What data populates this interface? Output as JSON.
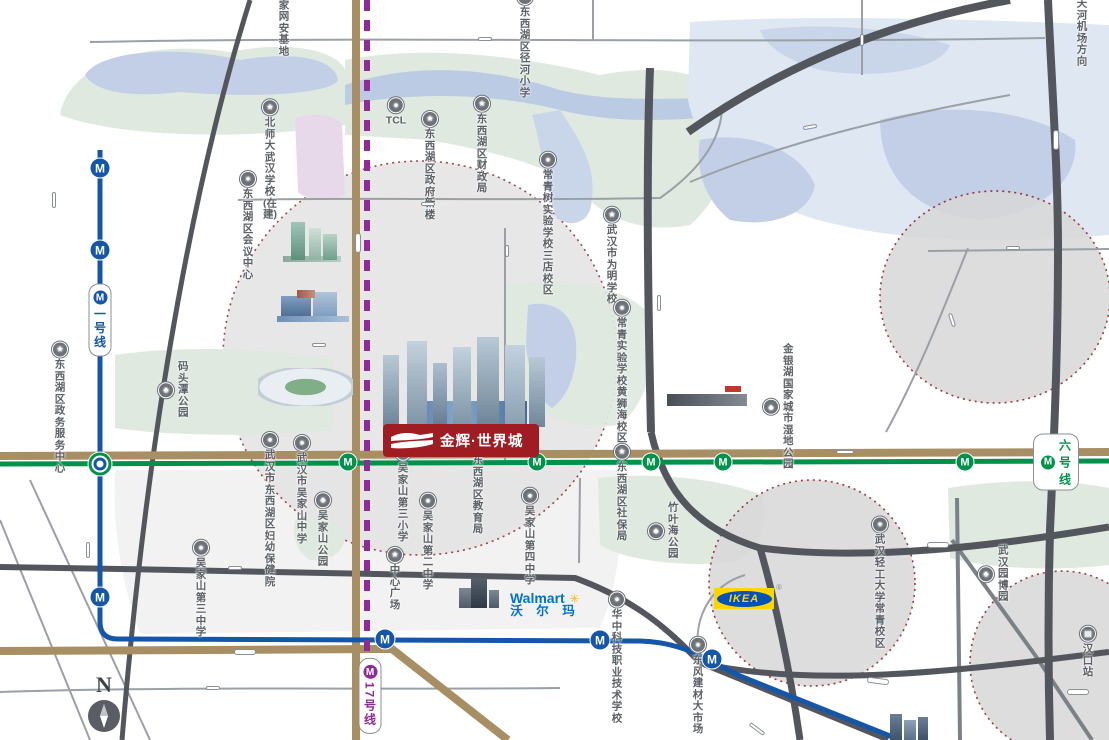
{
  "colors": {
    "line1": "#1456a8",
    "line6": "#00924a",
    "line17": "#8e2b96",
    "road_brown": "#a78e63",
    "road_dark": "#53575d",
    "circle_border": "#8b1b1b",
    "landmark_blue": "#1a57c5",
    "logo_red": "#9e1c22",
    "ikea_blue": "#0051ba",
    "ikea_yellow": "#ffd500",
    "walmart_blue": "#0071ce",
    "walmart_yellow": "#ffb71b",
    "park_green": "#dfe9df",
    "water_blue": "#c2cfe6"
  },
  "metro": {
    "m_glyph": "M"
  },
  "compass": {
    "n": "N"
  },
  "brands": {
    "project": {
      "name": "金辉·世界城"
    },
    "ikea": {
      "logo": "IKEA",
      "reg": "®"
    },
    "walmart": {
      "en": "Walmart",
      "spark": "✳",
      "zh": "沃 尔 玛"
    }
  },
  "caps": [
    {
      "t": "四环线",
      "x": 54,
      "y": 200,
      "cls": "v"
    },
    {
      "t": "临空港大道",
      "x": 358,
      "y": 243,
      "cls": "v big"
    },
    {
      "t": "机场高速",
      "x": 1056,
      "y": 140,
      "cls": "v big"
    },
    {
      "t": "硚孝高速",
      "x": 659,
      "y": 303,
      "cls": "v"
    },
    {
      "t": "九通路",
      "x": 88,
      "y": 550,
      "cls": "v"
    },
    {
      "t": "宏图六路",
      "x": 862,
      "y": 40,
      "cls": "v sm"
    },
    {
      "t": "三店路",
      "x": 507,
      "y": 251,
      "cls": "v sm"
    },
    {
      "t": "径河街",
      "x": 485,
      "y": 39,
      "cls": "sm"
    },
    {
      "t": "金北一路",
      "x": 428,
      "y": 204,
      "cls": "sm"
    },
    {
      "t": "祥云路",
      "x": 319,
      "y": 345,
      "cls": "sm"
    },
    {
      "t": "马池路",
      "x": 1013,
      "y": 248,
      "cls": "sm"
    },
    {
      "t": "金山大道",
      "x": 845,
      "y": 452,
      "cls": ""
    },
    {
      "t": "三环线",
      "x": 938,
      "y": 545,
      "cls": "big"
    },
    {
      "t": "东吴大道",
      "x": 235,
      "y": 568,
      "cls": "sm"
    },
    {
      "t": "东西湖大道",
      "x": 245,
      "y": 652,
      "cls": "big"
    },
    {
      "t": "平新大道",
      "x": 213,
      "y": 688,
      "cls": "sm"
    },
    {
      "t": "发展大道",
      "x": 1078,
      "y": 692,
      "cls": "big"
    },
    {
      "t": "环湖路",
      "x": 810,
      "y": 127,
      "cls": "sm",
      "rot": -10
    },
    {
      "t": "金银湖路",
      "x": 952,
      "y": 320,
      "cls": "sm",
      "rot": 72
    },
    {
      "t": "长丰大道高架",
      "x": 878,
      "y": 681,
      "cls": "big",
      "rot": 7
    },
    {
      "t": "解放大道",
      "x": 757,
      "y": 729,
      "cls": "",
      "rot": 37
    }
  ],
  "linecaps": [
    {
      "line": "l1",
      "t": "一号线",
      "x": 100,
      "y": 320,
      "cls": "v"
    },
    {
      "line": "l6",
      "t": "六号线",
      "x": 1056,
      "y": 462,
      "cls": ""
    },
    {
      "line": "l17",
      "t": "17号线",
      "x": 370,
      "y": 696,
      "cls": "v"
    }
  ],
  "stations": [
    {
      "line": "l1",
      "x": 100,
      "y": 168
    },
    {
      "line": "l1",
      "x": 100,
      "y": 250
    },
    {
      "line": "l1",
      "x": 100,
      "y": 597
    },
    {
      "line": "l1",
      "x": 385,
      "y": 639
    },
    {
      "line": "l1",
      "x": 600,
      "y": 640
    },
    {
      "line": "l1",
      "x": 712,
      "y": 659
    },
    {
      "line": "l6",
      "x": 348,
      "y": 462
    },
    {
      "line": "l6",
      "x": 537,
      "y": 462
    },
    {
      "line": "l6",
      "x": 651,
      "y": 462
    },
    {
      "line": "l6",
      "x": 723,
      "y": 462
    },
    {
      "line": "l6",
      "x": 965,
      "y": 462
    },
    {
      "line": "xch",
      "x": 100,
      "y": 464
    }
  ],
  "stnames": [
    {
      "t": "径河站",
      "x": 115,
      "y": 167,
      "a": "l",
      "line": "l1"
    },
    {
      "t": "三店站",
      "x": 115,
      "y": 248,
      "a": "l",
      "line": "l1"
    },
    {
      "t": "东吴大道站",
      "x": 116,
      "y": 593,
      "a": "l",
      "line": "l1"
    },
    {
      "t": "五环大道站",
      "x": 352,
      "y": 618,
      "a": "l",
      "line": "l1"
    },
    {
      "t": "额头湾站",
      "x": 578,
      "y": 618,
      "a": "l",
      "line": "l1"
    },
    {
      "t": "竹叶海站",
      "x": 706,
      "y": 640,
      "a": "l",
      "line": "l1"
    },
    {
      "t": "码头潭公园站",
      "x": 107,
      "y": 451,
      "a": "l",
      "line": "l6"
    },
    {
      "t": "五环体育中心站",
      "x": 361,
      "y": 475,
      "a": "l",
      "line": "l6"
    },
    {
      "t": "二雅路站",
      "x": 519,
      "y": 479,
      "a": "l",
      "line": "l6"
    },
    {
      "t": "径口二路站",
      "x": 606,
      "y": 479,
      "a": "l",
      "line": "l6"
    },
    {
      "t": "金银湖公园站",
      "x": 708,
      "y": 479,
      "a": "l",
      "line": "l6"
    },
    {
      "t": "金银湖站",
      "x": 924,
      "y": 470,
      "a": "l",
      "line": "l6"
    }
  ],
  "pois": [
    {
      "icon": "star",
      "g": "★",
      "t": "国家网安基地",
      "x": 284,
      "y": 14
    },
    {
      "icon": "star",
      "g": "★",
      "t": "北师大武汉学校\n(在建)",
      "x": 270,
      "y": 160
    },
    {
      "icon": "building",
      "g": "●",
      "t": "TCL",
      "x": 396,
      "y": 112
    },
    {
      "icon": "school",
      "g": "●",
      "t": "东西湖区径河小学",
      "x": 525,
      "y": 44
    },
    {
      "icon": "star",
      "g": "★",
      "t": "东西湖区财政局",
      "x": 482,
      "y": 145
    },
    {
      "icon": "star",
      "g": "★",
      "t": "东西湖区政府新楼",
      "x": 430,
      "y": 166
    },
    {
      "icon": "building",
      "g": "●",
      "t": "东西湖区会议中心",
      "x": 248,
      "y": 226
    },
    {
      "icon": "school",
      "g": "●",
      "t": "常青树实验学校\n三店校区",
      "x": 548,
      "y": 224
    },
    {
      "icon": "star",
      "g": "★",
      "t": "武汉市为明学校",
      "x": 612,
      "y": 256
    },
    {
      "icon": "school",
      "g": "●",
      "t": "常青实验学校\n黄狮海校区",
      "x": 622,
      "y": 372
    },
    {
      "icon": "tree",
      "g": "♣",
      "t": "码头潭公园",
      "x": 158,
      "y": 390,
      "cls": "side al"
    },
    {
      "icon": "star",
      "g": "★",
      "t": "东西湖区政务\n服务中心",
      "x": 60,
      "y": 408
    },
    {
      "icon": "school",
      "g": "●",
      "t": "武汉市吴家山中学",
      "x": 302,
      "y": 490
    },
    {
      "icon": "school",
      "g": "●",
      "t": "吴家山第三小学",
      "x": 403,
      "y": 494
    },
    {
      "icon": "star",
      "g": "★",
      "t": "东西湖区教育局",
      "x": 478,
      "y": 486
    },
    {
      "icon": "star",
      "g": "★",
      "t": "东西湖区社保局",
      "x": 622,
      "y": 493
    },
    {
      "icon": "tree",
      "g": "♣",
      "t": "竹叶海公园",
      "x": 648,
      "y": 531,
      "cls": "side al"
    },
    {
      "icon": "tree",
      "g": "♣",
      "t": "金银湖国家城市湿地公园",
      "x": 763,
      "y": 407,
      "cls": "side al"
    },
    {
      "icon": "hospital",
      "g": "●",
      "t": "武汉市东西湖区\n妇幼保健院",
      "x": 270,
      "y": 510
    },
    {
      "icon": "tree",
      "g": "♣",
      "t": "吴家山公园",
      "x": 323,
      "y": 530
    },
    {
      "icon": "school",
      "g": "●",
      "t": "吴家山第三中学",
      "x": 201,
      "y": 589
    },
    {
      "icon": "school",
      "g": "●",
      "t": "吴家山第二中学",
      "x": 428,
      "y": 542
    },
    {
      "icon": "school",
      "g": "●",
      "t": "吴家山第四中学",
      "x": 530,
      "y": 537
    },
    {
      "icon": "star",
      "g": "★",
      "t": "中心广场",
      "x": 395,
      "y": 579
    },
    {
      "icon": "school",
      "g": "●",
      "t": "华中科技职业技术学校",
      "x": 617,
      "y": 658
    },
    {
      "icon": "building",
      "g": "●",
      "t": "东风建材大市场",
      "x": 698,
      "y": 686
    },
    {
      "icon": "school",
      "g": "●",
      "t": "武汉轻工大学常青校区",
      "x": 880,
      "y": 583
    },
    {
      "icon": "tree",
      "g": "♣",
      "t": "武汉园博园",
      "x": 978,
      "y": 574,
      "cls": "side al"
    },
    {
      "icon": "train",
      "g": "▤",
      "t": "汉口站",
      "x": 1088,
      "y": 652
    },
    {
      "icon": "plane",
      "g": "✈",
      "t": "天河机场方向",
      "x": 1082,
      "y": 24
    }
  ],
  "landmarks": [
    {
      "t": "协和东西湖医院",
      "x": 300,
      "y": 268
    },
    {
      "t": "东西湖文化中心",
      "x": 299,
      "y": 356
    },
    {
      "t": "武汉五环\n体育中心",
      "x": 292,
      "y": 430
    },
    {
      "t": "万达商业中心",
      "x": 707,
      "y": 421
    },
    {
      "t": "海林广场",
      "x": 478,
      "y": 612
    },
    {
      "t": "宜家荟聚购物中心",
      "x": 747,
      "y": 621
    }
  ],
  "areas": [
    {
      "t": "径 河",
      "x": 405,
      "y": 87,
      "cls": "lake"
    },
    {
      "t": "金银湖",
      "x": 846,
      "y": 243,
      "cls": "lake"
    },
    {
      "t": "径河湿地公园",
      "x": 266,
      "y": 106,
      "cls": "parkname"
    },
    {
      "t": "黄狮海公园",
      "x": 577,
      "y": 352,
      "cls": "parkname2"
    },
    {
      "t": "临空科研片",
      "x": 321,
      "y": 158,
      "cls": "pink"
    },
    {
      "t": "永旺\n商圈",
      "x": 1016,
      "y": 307,
      "cls": "biz"
    },
    {
      "t": "宜家\n商圈",
      "x": 810,
      "y": 592,
      "cls": "biz"
    },
    {
      "t": "武广\n商圈",
      "x": 1016,
      "y": 631,
      "cls": "biz"
    }
  ]
}
